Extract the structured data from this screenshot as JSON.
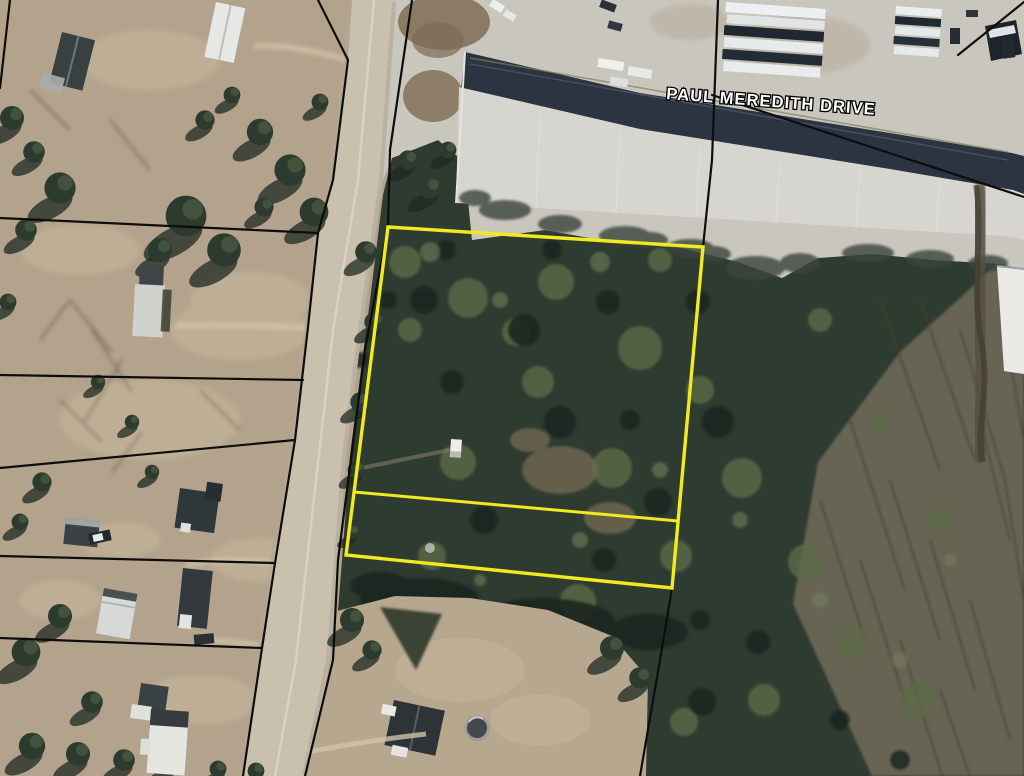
{
  "map": {
    "street_label": "PAUL MEREDITH DRIVE",
    "colors": {
      "highlight_outline": "#f2e91e",
      "boundary_lines": "#0d0d0d",
      "ground_tan": "#b4a38c",
      "woods_green": "#2e3b30",
      "road_surface": "#c9c0ae",
      "pavement_gray": "#c9c6bd",
      "warehouse_roof": "#d7d5cf",
      "warehouse_shadow_band": "#2b3440",
      "street_label_fill": "#ffffff",
      "street_label_outline": "#000000"
    }
  }
}
